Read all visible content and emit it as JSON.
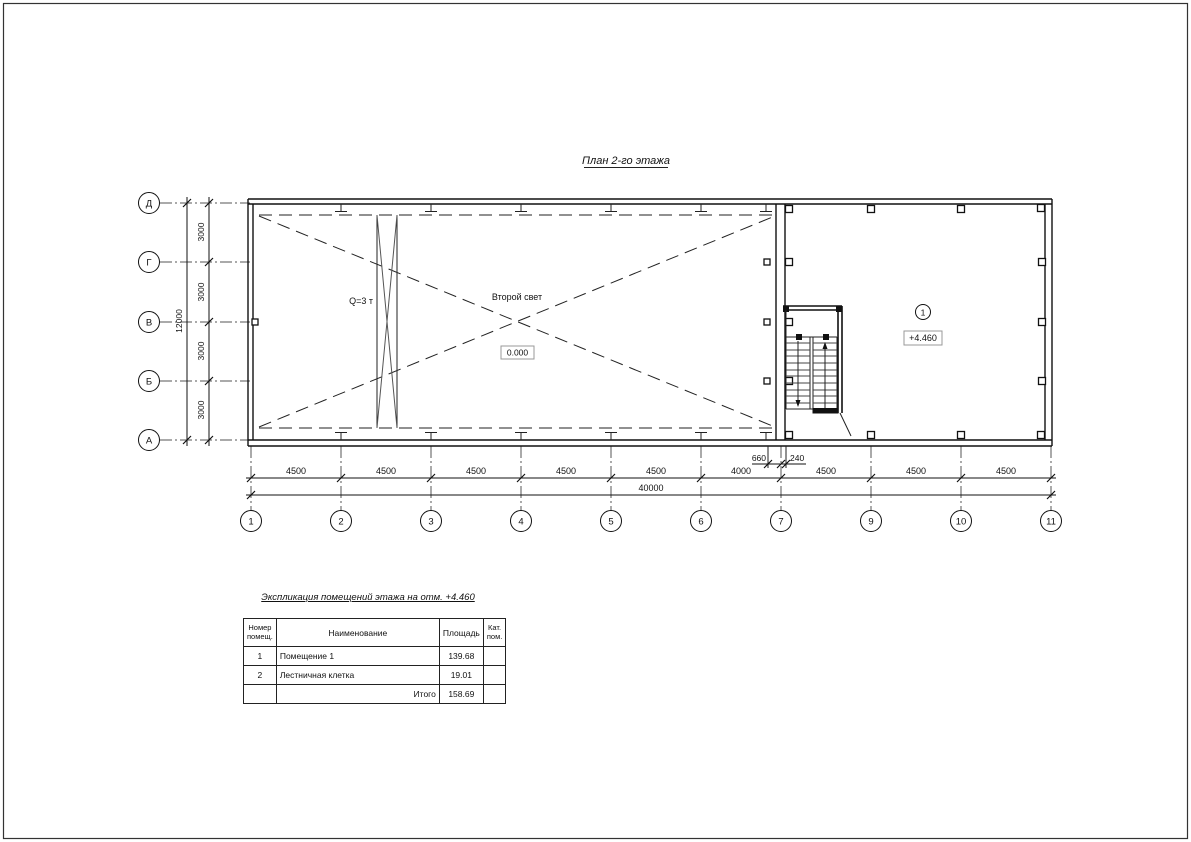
{
  "title": "План 2-го этажа",
  "plan": {
    "crane_label": "Q=3 т",
    "void_label": "Второй свет",
    "level_ground": "0.000",
    "room_number": "1",
    "level_floor": "+4.460"
  },
  "axes": {
    "rows": [
      "Д",
      "Г",
      "В",
      "Б",
      "А"
    ],
    "cols": [
      "1",
      "2",
      "3",
      "4",
      "5",
      "6",
      "7",
      "9",
      "10",
      "11"
    ]
  },
  "dims": {
    "left_total": "12000",
    "left_segments": [
      "3000",
      "3000",
      "3000",
      "3000"
    ],
    "bottom_segments": [
      "4500",
      "4500",
      "4500",
      "4500",
      "4500",
      "4000",
      "4500",
      "4500",
      "4500"
    ],
    "bottom_total": "40000",
    "detail_left": "660",
    "detail_right": "240"
  },
  "table": {
    "title": "Экспликация помещений этажа на отм. +4.460",
    "headers": {
      "num": "Номер\nпомещ.",
      "name": "Наименование",
      "area": "Площадь",
      "cat": "Кат.\nпом."
    },
    "rows": [
      {
        "num": "1",
        "name": "Помещение 1",
        "area": "139.68",
        "cat": ""
      },
      {
        "num": "2",
        "name": "Лестничная клетка",
        "area": "19.01",
        "cat": ""
      }
    ],
    "total_label": "Итого",
    "total_area": "158.69"
  }
}
